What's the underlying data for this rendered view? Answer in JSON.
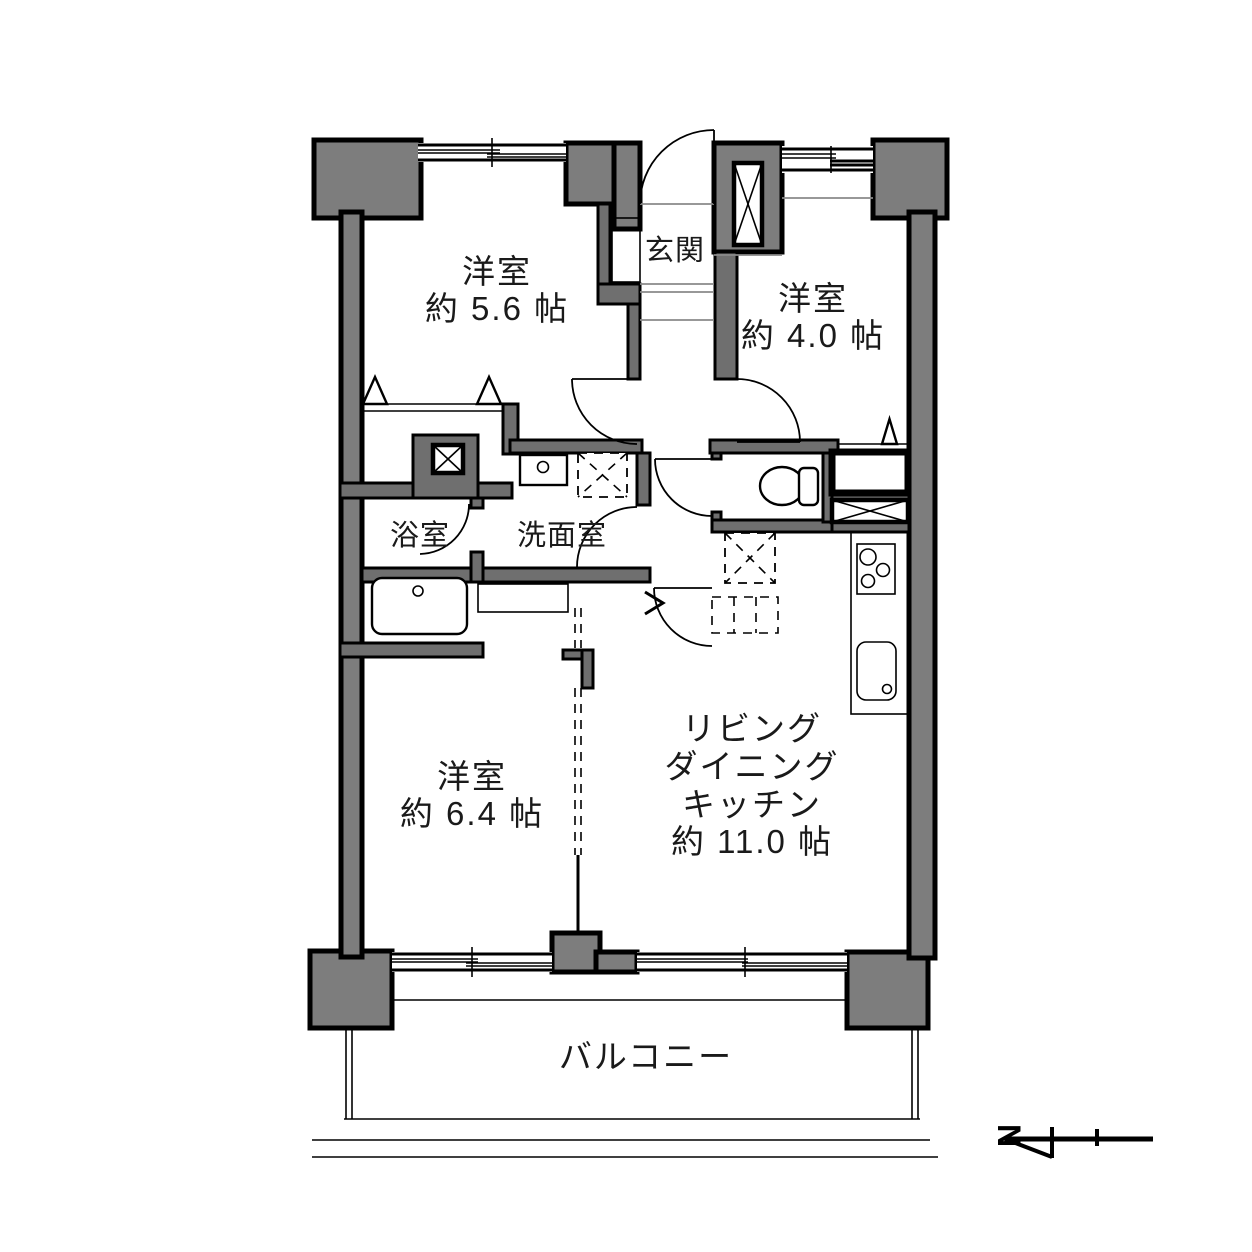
{
  "plan_title": "2LDK apartment floor plan",
  "rooms": {
    "bedroom_a": {
      "label": "洋室",
      "area": "約 5.6 帖"
    },
    "bedroom_b": {
      "label": "洋室",
      "area": "約 4.0 帖"
    },
    "bedroom_c": {
      "label": "洋室",
      "area": "約 6.4 帖"
    },
    "ldk": {
      "label_line1": "リビング",
      "label_line2": "ダイニング",
      "label_line3": "キッチン",
      "area": "約 11.0 帖"
    },
    "entrance": {
      "label": "玄関"
    },
    "bathroom": {
      "label": "浴室"
    },
    "washroom": {
      "label": "洗面室"
    },
    "balcony": {
      "label": "バルコニー"
    }
  },
  "compass": {
    "north_label": "N"
  },
  "colors": {
    "wall_fill": "#7d7d7d",
    "interior_wall_fill": "#6f6f6f",
    "wall_outline": "#000000",
    "background": "#ffffff"
  }
}
